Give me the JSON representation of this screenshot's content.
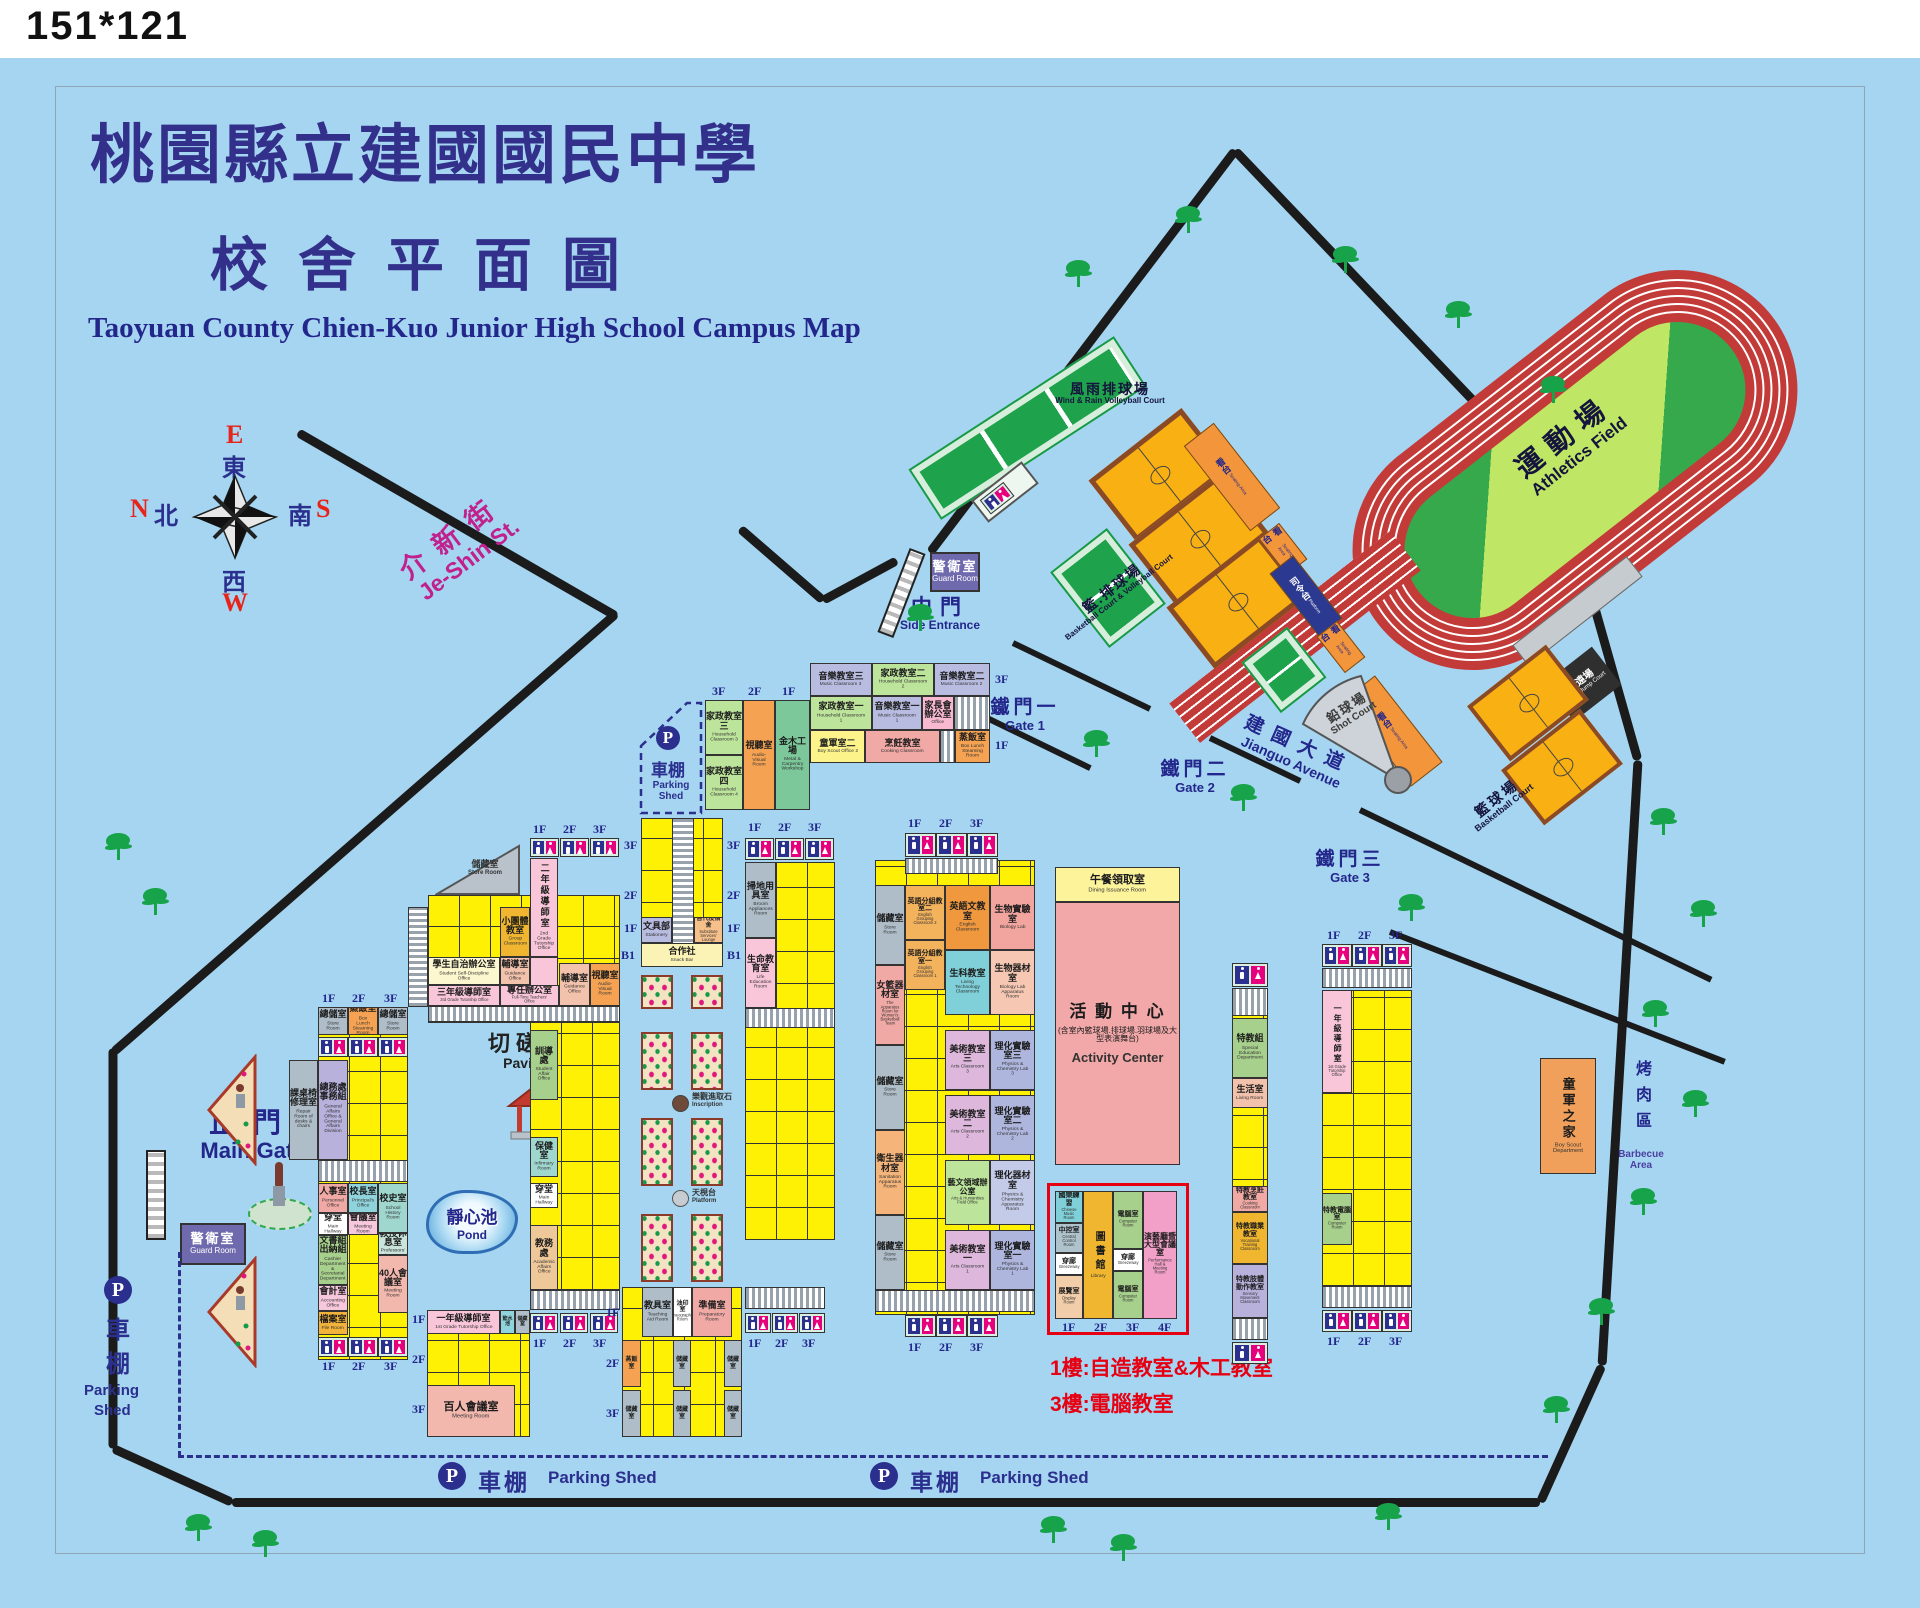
{
  "corner": "151*121",
  "title": {
    "zh1": "桃園縣立建國國民中學",
    "zh2": "校舍平面圖",
    "en": "Taoyuan County Chien-Kuo Junior High School Campus Map"
  },
  "compass": {
    "e": "E",
    "east": "東",
    "n": "N",
    "north": "北",
    "s": "S",
    "south": "南",
    "w": "W",
    "west": "西"
  },
  "streets": {
    "jeshin_zh": "介新街",
    "jeshin_en": "Je-Shin St.",
    "jianguo_zh": "建國大道",
    "jianguo_en": "Jianguo Avenue"
  },
  "gates": {
    "main_zh": "正門",
    "main_en": "Main Gate",
    "side_zh": "中門",
    "side_en": "Side Entrance",
    "g1_zh": "鐵門一",
    "g1_en": "Gate 1",
    "g2_zh": "鐵門二",
    "g2_en": "Gate 2",
    "g3_zh": "鐵門三",
    "g3_en": "Gate 3"
  },
  "labels": {
    "guard_zh": "警衛室",
    "guard_en": "Guard Room",
    "parking_zh": "車棚",
    "parking_en": "Parking Shed",
    "p1": "車",
    "p2": "棚",
    "pen1": "Parking",
    "pen2": "Shed",
    "pavilion_zh": "切磋亭",
    "pavilion_en": "Pavilion",
    "pond_zh": "靜心池",
    "pond_en": "Pond",
    "inscription_zh": "樂觀進取石",
    "inscription_en": "Inscription",
    "platform_zh": "天梘台",
    "platform_en": "Platform",
    "store_tri_zh": "儲藏室",
    "store_tri_en": "Store Room",
    "boyscout_zh": "童軍之家",
    "boyscout_en": "Boy Scout Department",
    "bbq_zh": "烤肉區",
    "bbq_en": "Barbecue Area",
    "note1": "1樓:自造教室&木工教室",
    "note2": "3樓:電腦教室"
  },
  "sports": {
    "field_zh": "運動場",
    "field_en": "Athletics Field",
    "windrain_zh": "風雨排球場",
    "windrain_en": "Wind & Rain Volleyball Court",
    "bbvb_zh": "籃.排球場",
    "bbvb_en": "Basketball Court & Volleyball Court",
    "bball_zh": "籃球場",
    "bball_en": "Basketball Court",
    "seat_zh": "看台",
    "seat_en": "Seating Area",
    "cmd_zh": "司令台",
    "cmd_en": "Platform",
    "jump_zh": "跳遠場",
    "jump_en": "Broad Jump Court",
    "shot_zh": "鉛球場",
    "shot_en": "Shot Court",
    "dining_zh": "午餐領取室",
    "dining_en": "Dining Issuance Room",
    "act_zh": "活 動 中 心",
    "act_sub": "(含室內籃球場.排球場.羽球場及大型表演舞台)",
    "act_en": "Activity Center"
  },
  "floors": {
    "f1": "1F",
    "f2": "2F",
    "f3": "3F",
    "f4": "4F",
    "b1": "B1"
  },
  "rooms": [
    {
      "z": "家政教室三",
      "e": "Household Classroom 3"
    },
    {
      "z": "家政教室四",
      "e": "Household Classroom 4"
    },
    {
      "z": "視聽室",
      "e": "Audio-Visual Room"
    },
    {
      "z": "金木工場",
      "e": "Metal & Carpentry Workshop"
    },
    {
      "z": "音樂教室三",
      "e": "Music Classroom 3"
    },
    {
      "z": "家政教室二",
      "e": "Household Classroom 2"
    },
    {
      "z": "音樂教室二",
      "e": "Music Classroom 2"
    },
    {
      "z": "家政教室一",
      "e": "Household Classroom 1"
    },
    {
      "z": "音樂教室一",
      "e": "Music Classroom 1"
    },
    {
      "z": "家長會辦公室",
      "e": "Office"
    },
    {
      "z": "童軍室二",
      "e": "Boy Scout Office 2"
    },
    {
      "z": "烹飪教室",
      "e": "Cooking Classroom"
    },
    {
      "z": "蒸飯室",
      "e": "Box Lunch Steaming Room"
    },
    {
      "z": "總儲室",
      "e": "Store Room"
    },
    {
      "z": "蒸飯室",
      "e": "Box Lunch Steaming Room"
    },
    {
      "z": "總儲室",
      "e": "Store Room"
    },
    {
      "z": "課桌椅修理室",
      "e": "Repair Room of desks & chairs"
    },
    {
      "z": "總務處事務組",
      "e": "General Affairs Office & General Affairs Division"
    },
    {
      "z": "人事室",
      "e": "Personnel Office"
    },
    {
      "z": "校長室",
      "e": "Principal's Office"
    },
    {
      "z": "校史室",
      "e": "School History Room"
    },
    {
      "z": "穿堂",
      "e": "Main Hallway"
    },
    {
      "z": "會議室",
      "e": "Meeting Room"
    },
    {
      "z": "文書組出納組",
      "e": "Cashier Department & Secretarial Department"
    },
    {
      "z": "教授休息室",
      "e": "Professors' Lounge"
    },
    {
      "z": "40人會議室",
      "e": "Meeting Room"
    },
    {
      "z": "會計室",
      "e": "Accounting Office"
    },
    {
      "z": "檔案室",
      "e": "File Room"
    },
    {
      "z": "一年級導師室",
      "e": "1st Grade Tutorship Office"
    },
    {
      "z": "飲水池",
      "e": ""
    },
    {
      "z": "儲藏室",
      "e": "Store Room"
    },
    {
      "z": "百人會議室",
      "e": "Meeting Room"
    },
    {
      "z": "小團體教室",
      "e": "Group Classroom"
    },
    {
      "z": "二年級導師室",
      "e": "2nd Grade Tutorship Office"
    },
    {
      "z": "學生自治辦公室",
      "e": "Student Self-Discipline Office"
    },
    {
      "z": "輔導室",
      "e": "Guidance Office"
    },
    {
      "z": "三年級導師室",
      "e": "3rd Grade Tutorship Office"
    },
    {
      "z": "專任辦公室",
      "e": "Full-Time Teachers' Office"
    },
    {
      "z": "輔導室",
      "e": "Guidance Office"
    },
    {
      "z": "視聽室",
      "e": "Audio-Visual Room"
    },
    {
      "z": "訓導處",
      "e": "Student Affair Office"
    },
    {
      "z": "保健室",
      "e": "Infirmary Room"
    },
    {
      "z": "穿堂",
      "e": "Main Hallway"
    },
    {
      "z": "教務處",
      "e": "Academic Affairs Office"
    },
    {
      "z": "文具部",
      "e": "Stationery"
    },
    {
      "z": "替代役宿舍",
      "e": "Substitute Services' Lounge"
    },
    {
      "z": "合作社",
      "e": "Snack Bar"
    },
    {
      "z": "掃地用具室",
      "e": "Broom Appliances Room"
    },
    {
      "z": "生命教育室",
      "e": "Life Education Room"
    },
    {
      "z": "教具室",
      "e": "Teaching Aid Room"
    },
    {
      "z": "油印室",
      "e": "Mimeographing Room"
    },
    {
      "z": "準備室",
      "e": "Preparatory Room"
    },
    {
      "z": "蒸飯室",
      "e": "Box Lunch Steaming Room"
    },
    {
      "z": "儲藏室",
      "e": "Store Room"
    },
    {
      "z": "女籃器材室",
      "e": "The Apparatus Room for Women's Basketball Team"
    },
    {
      "z": "衛生器材室",
      "e": "Sanitation Apparatus Room"
    },
    {
      "z": "英語分組教室二",
      "e": "English Grouping Classroom 2"
    },
    {
      "z": "英語分組教室一",
      "e": "English Grouping Classroom 1"
    },
    {
      "z": "英語文教室",
      "e": "English Classroom"
    },
    {
      "z": "生科教室",
      "e": "Living Technology Classroom"
    },
    {
      "z": "美術教室三",
      "e": "Arts Classroom 3"
    },
    {
      "z": "美術教室二",
      "e": "Arts Classroom 2"
    },
    {
      "z": "藝文領域辦公室",
      "e": "Arts & Humanities Field Office"
    },
    {
      "z": "美術教室一",
      "e": "Arts Classroom 1"
    },
    {
      "z": "生物實驗室",
      "e": "Biology Lab"
    },
    {
      "z": "生物器材室",
      "e": "Biology Lab Apparatus Room"
    },
    {
      "z": "理化實驗室三",
      "e": "Physics & Chemistry Lab 3"
    },
    {
      "z": "理化實驗室二",
      "e": "Physics & Chemistry Lab 2"
    },
    {
      "z": "理化器材室",
      "e": "Physics & Chemistry Apparatus Room"
    },
    {
      "z": "理化實驗室一",
      "e": "Physics & Chemistry Lab 1"
    },
    {
      "z": "國樂練習",
      "e": "Chinese Music Room"
    },
    {
      "z": "中控室",
      "e": "Central Control Room"
    },
    {
      "z": "穿廊",
      "e": "Breezeway"
    },
    {
      "z": "展覽室",
      "e": "Display Room"
    },
    {
      "z": "圖書館",
      "e": "Library"
    },
    {
      "z": "電腦室",
      "e": "Computer Room"
    },
    {
      "z": "演藝廳暨大型會議室",
      "e": "Performance Hall & Meeting Room"
    },
    {
      "z": "特教組",
      "e": "Special Education Department"
    },
    {
      "z": "生活室",
      "e": "Living Room"
    },
    {
      "z": "特教烹飪教室",
      "e": "Cooking Classroom"
    },
    {
      "z": "特教職業教室",
      "e": "Vocational Training Classroom"
    },
    {
      "z": "特教肢體動作教室",
      "e": "Sensory Movement Classroom"
    },
    {
      "z": "一年級導師室",
      "e": "1st Grade Tutorship Office"
    },
    {
      "z": "特教電腦室",
      "e": "Computer Room"
    }
  ]
}
